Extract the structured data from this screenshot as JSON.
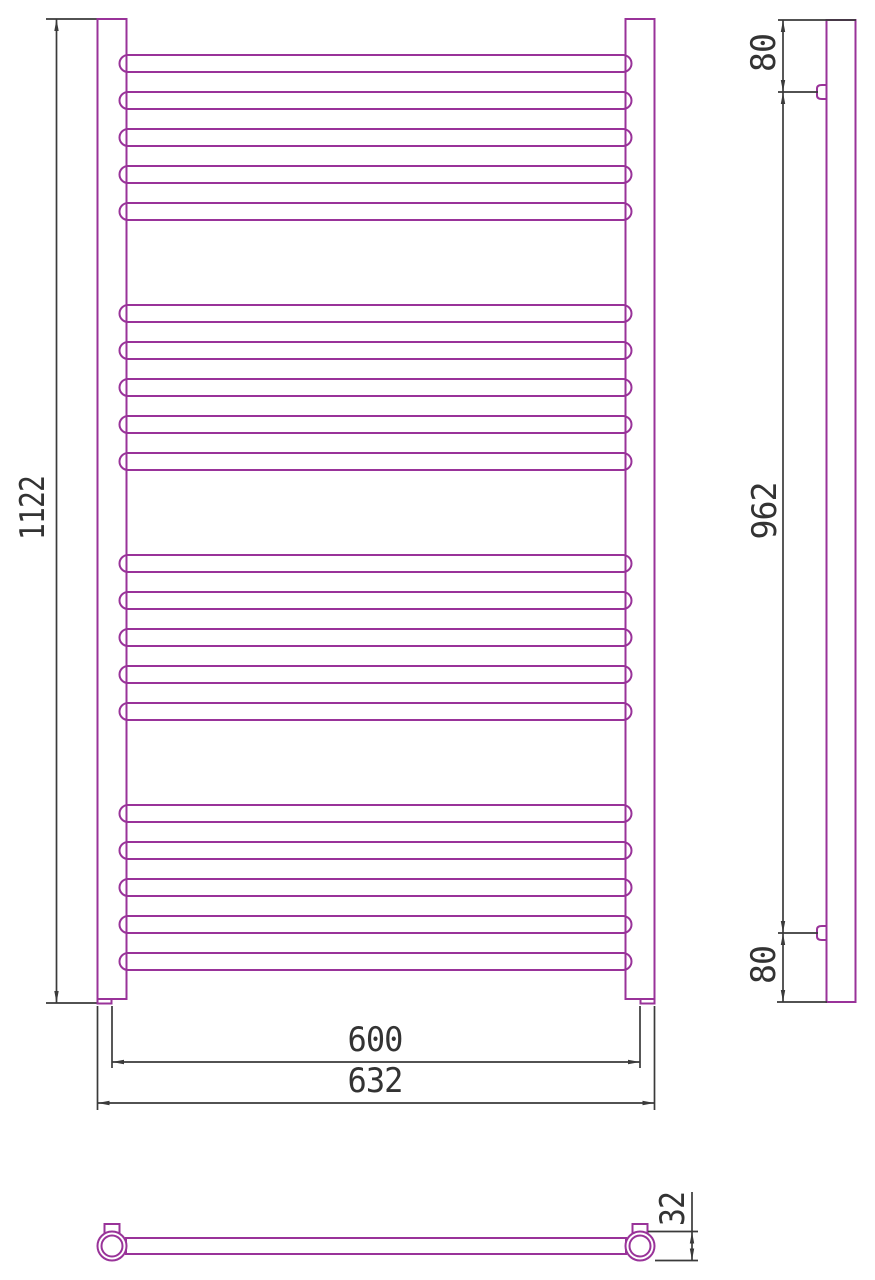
{
  "colors": {
    "tube_outline": "#993399",
    "dimension_lines": "#3a3a3a",
    "background": "#ffffff"
  },
  "front_view": {
    "labels": {
      "height": "1122",
      "axle_width": "600",
      "overall_width": "632"
    },
    "rungs": {
      "group_count": 4,
      "rungs_per_group": 5
    }
  },
  "side_view": {
    "labels": {
      "top_bracket_offset": "80",
      "bracket_spacing": "962",
      "bottom_bracket_offset": "80"
    }
  },
  "bottom_view": {
    "labels": {
      "tube_diameter": "32"
    }
  }
}
